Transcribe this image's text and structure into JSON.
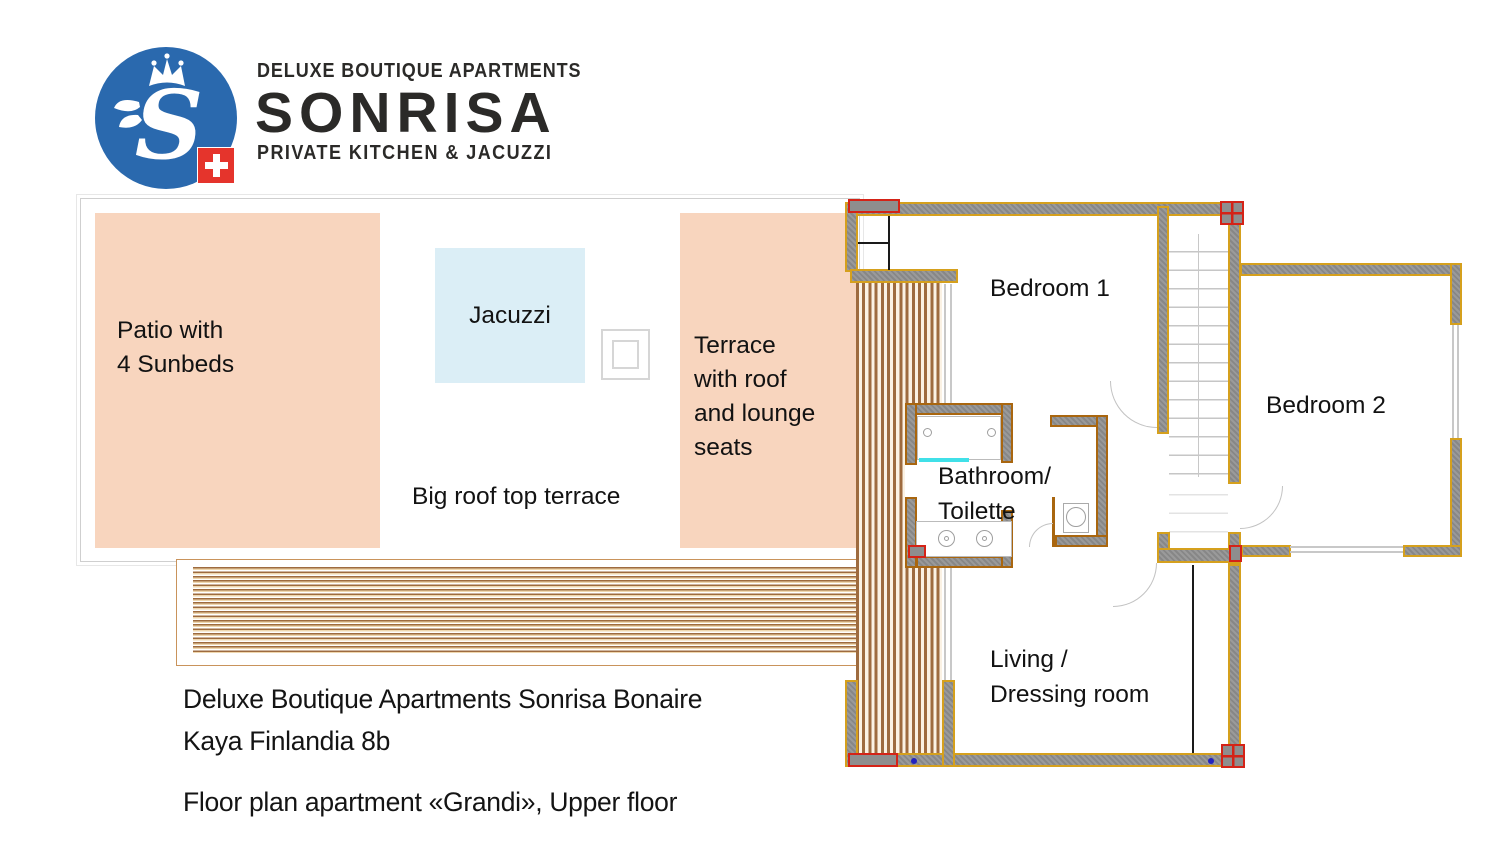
{
  "logo": {
    "tagline_top": "DELUXE BOUTIQUE APARTMENTS",
    "brand": "SONRISA",
    "tagline_bottom": "PRIVATE KITCHEN & JACUZZI",
    "monogram": "S"
  },
  "terrace": {
    "patio": {
      "line1": "Patio with",
      "line2": "4 Sunbeds"
    },
    "jacuzzi_label": "Jacuzzi",
    "roof_terrace": {
      "line1": "Terrace",
      "line2": "with roof",
      "line3": "and lounge",
      "line4": "seats"
    },
    "big_label": "Big roof top terrace"
  },
  "rooms": {
    "bedroom1": "Bedroom 1",
    "bedroom2": "Bedroom 2",
    "bathroom": {
      "line1": "Bathroom/",
      "line2": "Toilette"
    },
    "living": {
      "line1": "Living /",
      "line2": "Dressing room"
    }
  },
  "footer": {
    "address1": "Deluxe Boutique Apartments Sonrisa Bonaire",
    "address2": "Kaya Finlandia 8b",
    "caption": "Floor plan apartment «Grandi», Upper floor"
  },
  "colors": {
    "brand_blue": "#2A69AE",
    "flag_red": "#E5342C",
    "patio_salmon": "#F8D5BE",
    "jacuzzi_blue": "#DBEEF6",
    "wall_gray": "#8E8E8E",
    "wall_outline_gold": "#D5A01D",
    "bath_wall_outline": "#A9660F",
    "marker_red": "#D42317",
    "deck_brown": "#9E6B3F",
    "shower_cyan": "#40E0E8"
  }
}
